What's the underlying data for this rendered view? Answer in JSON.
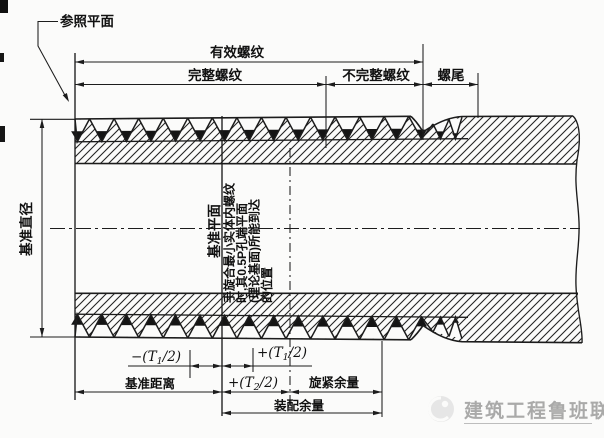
{
  "drawing": {
    "reference_plane_label": "参照平面",
    "top_dimensions": {
      "effective_thread": "有效螺纹",
      "complete_thread": "完整螺纹",
      "incomplete_thread": "不完整螺纹",
      "thread_runout": "螺尾"
    },
    "left_dimension": {
      "gauge_diameter": "基准直径"
    },
    "middle_labels": {
      "gauge_plane": "基准平面",
      "hand_tight_note_lines": [
        "手旋合最小实体内螺纹",
        "时,其0.5P孔端平面",
        "(理论基面)所能到达",
        "的位置"
      ]
    },
    "bottom_dimensions": {
      "minus_t1_half": {
        "pre": "−(T",
        "sub": "1",
        "post": "/2)"
      },
      "plus_t1_half": {
        "pre": "+(T",
        "sub": "1",
        "post": "/2)"
      },
      "plus_t2_half": {
        "pre": "+(T",
        "sub": "2",
        "post": "/2)"
      },
      "gauge_length": "基准距离",
      "tightening_allowance": "旋紧余量",
      "assembly_allowance": "装配余量"
    },
    "watermark": {
      "text": "建筑工程鲁班联盟"
    },
    "colors": {
      "line": "#1c1c1c",
      "watermark_gray": "#9c9c9c",
      "background": "#fbfbfa"
    }
  }
}
